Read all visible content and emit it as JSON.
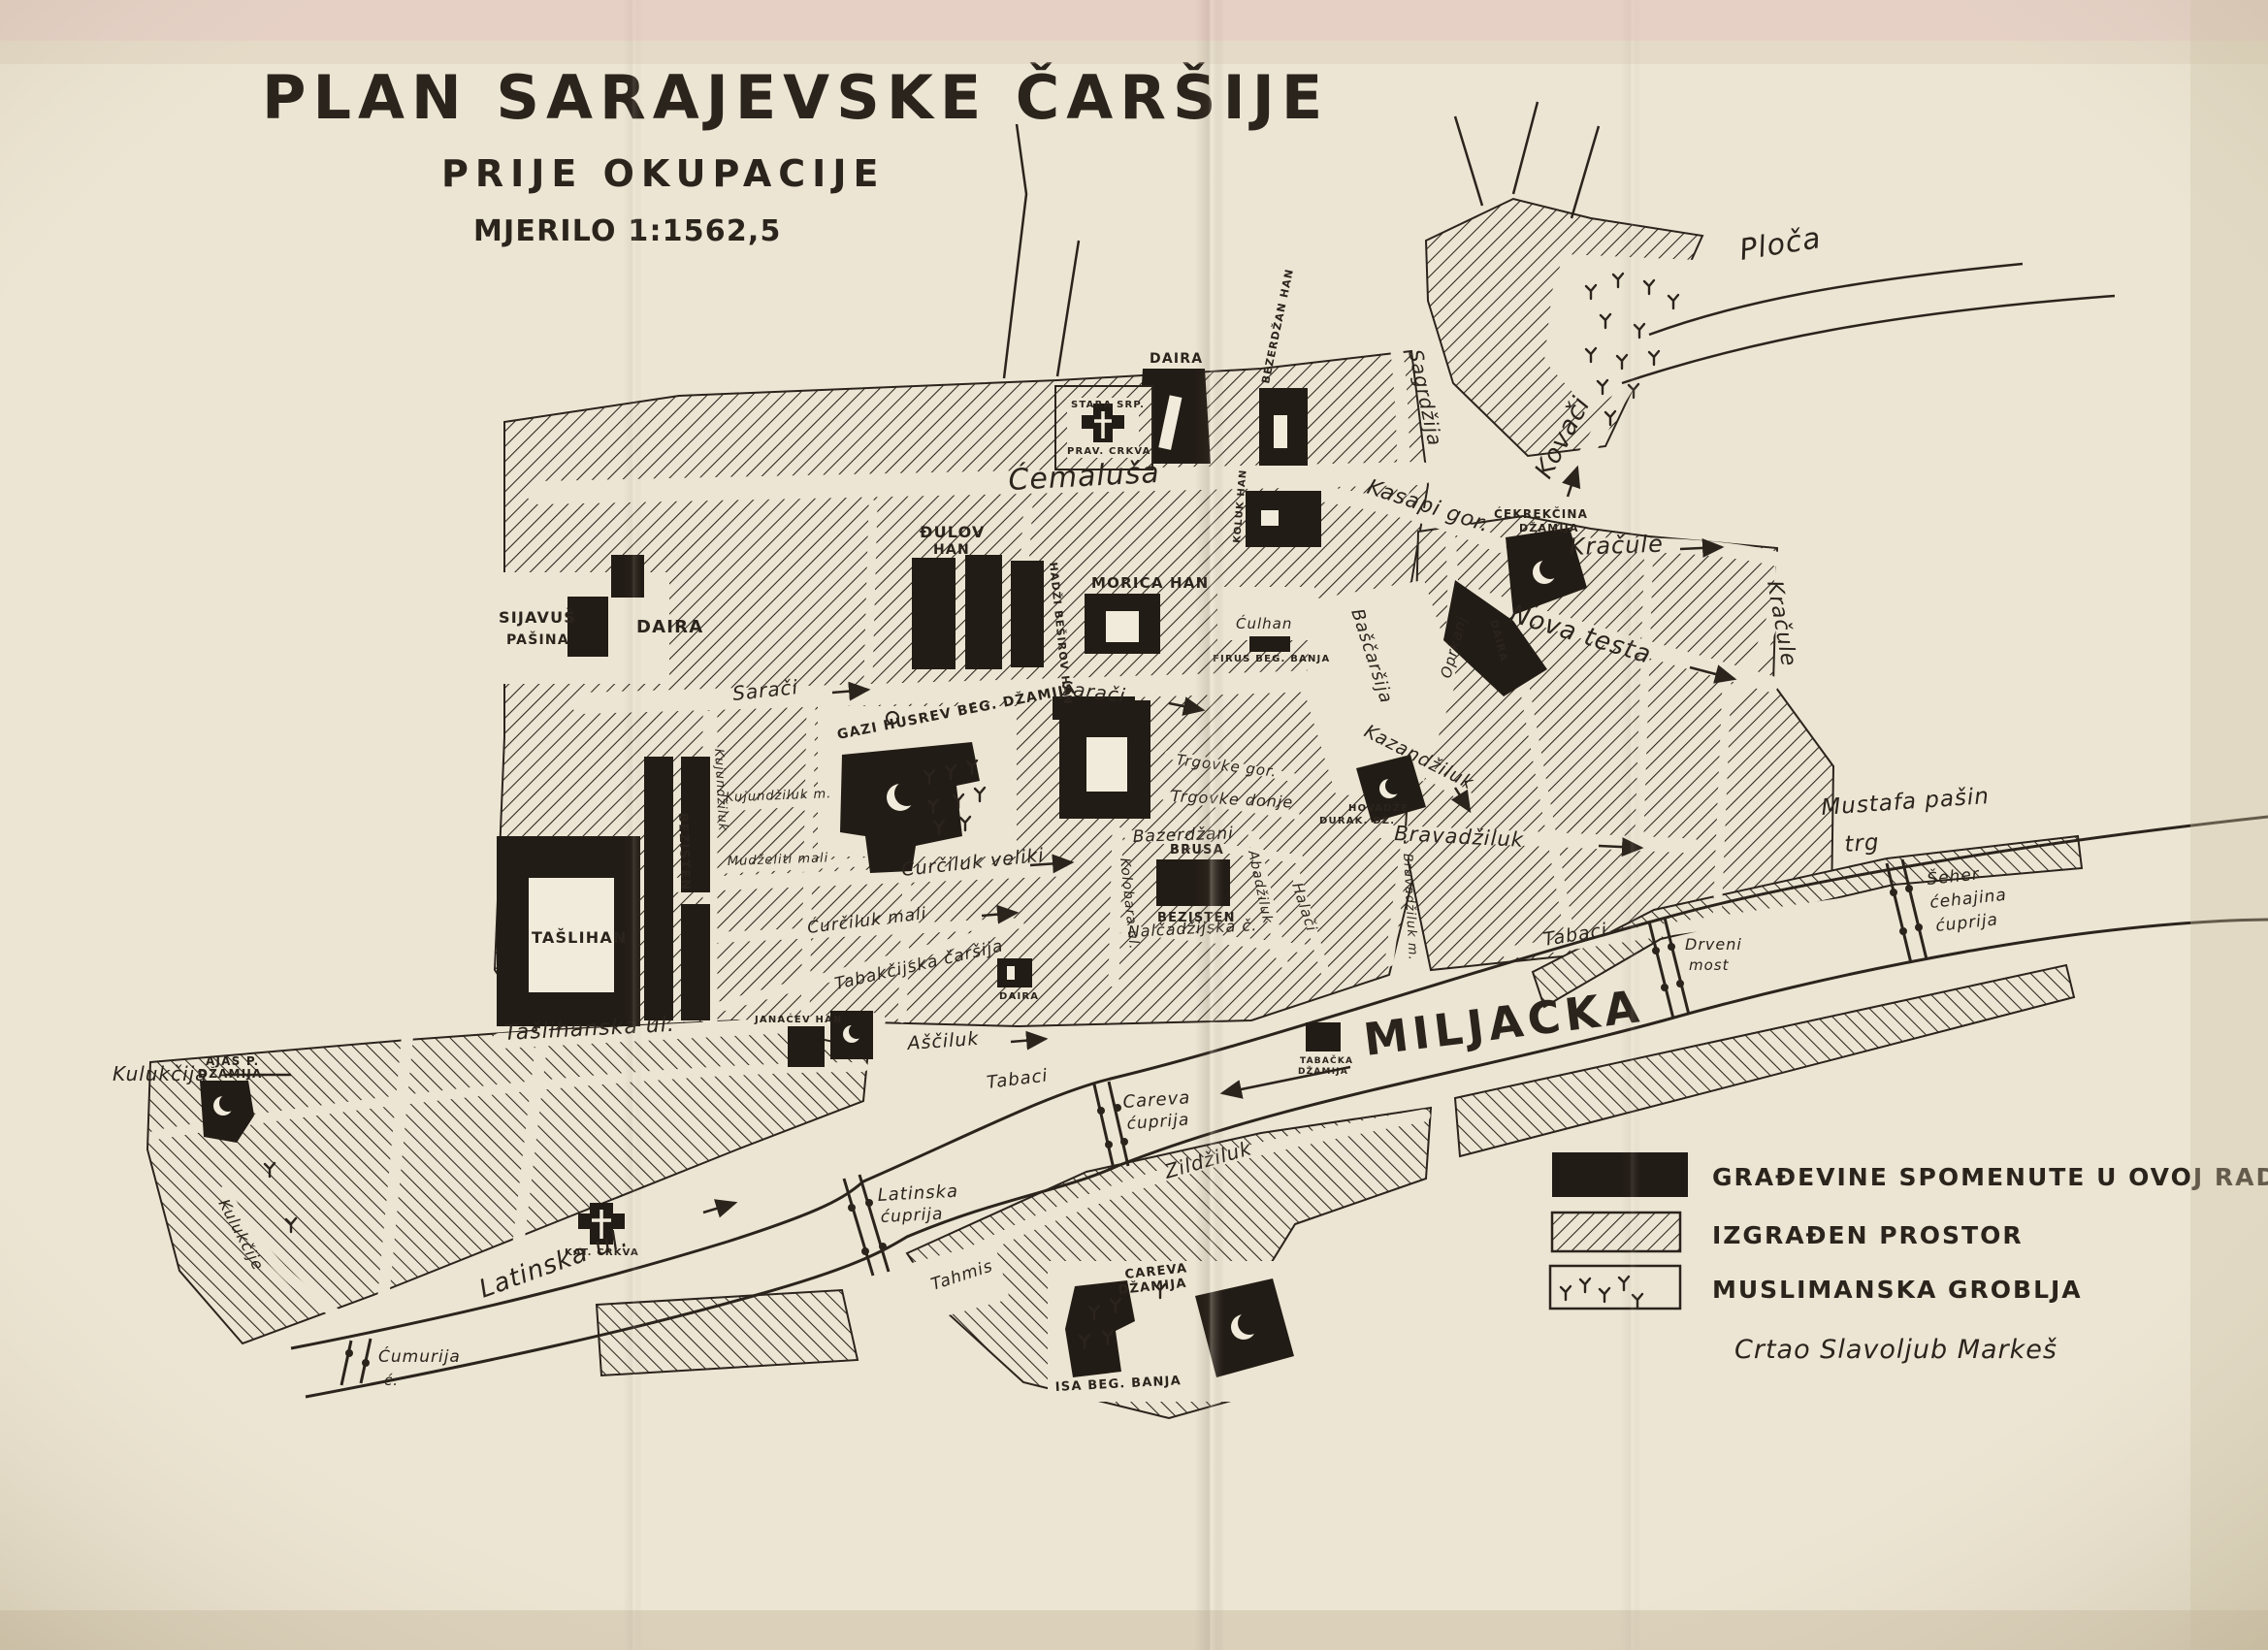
{
  "title": {
    "main": "PLAN SARAJEVSKE ČARŠIJE",
    "sub": "PRIJE OKUPACIJE",
    "scale": "MJERILO 1:1562,5"
  },
  "legend": {
    "built_buildings": "GRAĐEVINE SPOMENUTE U OVOJ RADNJI",
    "built_area": "IZGRAĐEN PROSTOR",
    "cemeteries": "MUSLIMANSKA GROBLJA"
  },
  "credit": "Crtao Slavoljub Markeš",
  "river": {
    "name": "MILJACKA"
  },
  "colors": {
    "paper": "#ece5d3",
    "ink": "#2b241d",
    "building_black": "#221c16"
  },
  "streets": {
    "cemalusa": "Ćemaluša",
    "kasapi": "Kasapi gor.",
    "sagrdzija": "Sagrdžija",
    "kovaci": "Kovači",
    "ploca": "Ploča",
    "kracule_h": "Kračule",
    "kracule_v": "Kračule",
    "nova_testa": "Nova testa",
    "oprkanj": "Oprkanj",
    "bascarsija": "Baščaršija",
    "kazandziluk": "Kazandžiluk",
    "bravadziluk": "Bravadžiluk",
    "bravadziluk_m": "Bravadžiluk m.",
    "tabaci_e": "Tabaci",
    "tabaci_w": "Tabaci",
    "asciluk": "Aščiluk",
    "halaci": "Halači",
    "abadziluk": "Abadžiluk",
    "trgovke_g": "Trgovke gor.",
    "trgovke_d": "Trgovke donje",
    "bazerdzani": "Bazerdžani",
    "nalcadzijska": "Nalčadžijska č.",
    "kolobara": "Kolobara ul.",
    "curciluk_v": "Ćurčiluk veliki",
    "curciluk_m": "Ćurčiluk mali",
    "mudzeliti_m": "Mudželiti mali",
    "kujundziluk": "Kujundžiluk",
    "kujundziluk_m": "Kujundžiluk m.",
    "saraci_w": "Sarači",
    "saraci_e": "Sarači",
    "tabakcijska": "Tabakčijska čaršija",
    "taslihanska": "Tašlihanska ul.",
    "latinska": "Latinska ul.",
    "kulukcije": "Kulukčije",
    "zildziluk": "Zildžiluk",
    "tahmis": "Tahmis",
    "mustafa_trg_1": "Mustafa pašin",
    "mustafa_trg_2": "trg"
  },
  "buildings": {
    "taslihan": "TAŠLIHAN",
    "bezisten_w": "BEZISTEN",
    "gazi": "GAZI HUSREV BEG. DŽAMIJA",
    "sijavus_1": "SIJAVUŠ",
    "sijavus_2": "PAŠINA",
    "sijavus_daira": "DAIRA",
    "daira_top": "DAIRA",
    "stara_1": "STARA SRP.",
    "stara_2": "PRAV. CRKVA",
    "bezerdzan_han": "BEZERDŽAN HAN",
    "koluk_han": "KOLUK HAN",
    "cekrekcina_1": "ĆEKREKČINA",
    "cekrekcina_2": "DŽAMIJA",
    "djulov_1": "ĐULOV",
    "djulov_2": "HAN",
    "hadzi_besirov": "HADŽI BEŠIROV HAN",
    "morica_han": "MORIĆA HAN",
    "culhan": "Ćulhan",
    "firus": "FIRUS BEG. BANJA",
    "brusa_1": "BRUSA",
    "brusa_2": "BEZISTEN",
    "hovadze_1": "HOVADŽE",
    "hovadze_2": "DURAK. DŽ.",
    "janacev": "JANAĆEV HAN",
    "daira_small": "DAIRA",
    "daira_vert": "DAIRA",
    "tabacka_1": "TABAČKA",
    "tabacka_2": "DŽAMIJA",
    "careva_dz_1": "CAREVA",
    "careva_dz_2": "DŽAMIJA",
    "isabeg": "ISA BEG. BANJA",
    "kat_crkva": "KAT. CRKVA",
    "ajas_1": "AJAS P.",
    "ajas_2": "DŽAMIJA",
    "kulukcija": "Kulukčija"
  },
  "bridges": {
    "cumurija_1": "Ćumurija",
    "cumurija_2": "ć.",
    "latinska_1": "Latinska",
    "latinska_2": "ćuprija",
    "careva_1": "Careva",
    "careva_2": "ćuprija",
    "drveni_1": "Drveni",
    "drveni_2": "most",
    "seher_1": "Šeher",
    "seher_2": "ćehajina",
    "seher_3": "ćuprija"
  }
}
